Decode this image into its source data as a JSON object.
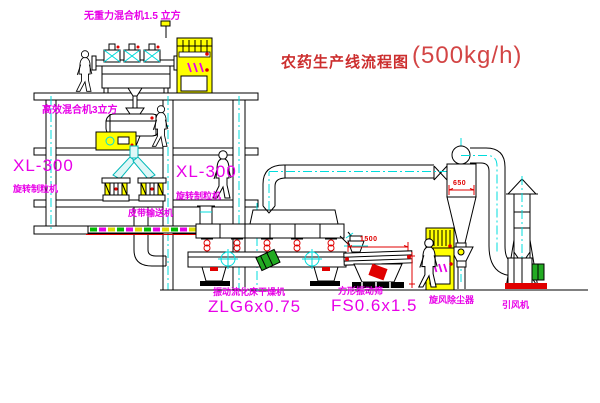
{
  "diagram": {
    "title": "农药生产线流程图",
    "capacity": "(500kg/h)"
  },
  "labels": {
    "top_mixer": "无重力混合机1.5 立方",
    "high_efficiency_mixer": "高效混合机3立方",
    "granulator_left_model": "XL-300",
    "granulator_left_name": "旋转制粒机",
    "granulator_right_model": "XL-300",
    "granulator_right_name": "旋转制粒机",
    "belt_conveyor": "皮带输送机",
    "fluid_bed_dryer_name": "振动流化床干燥机",
    "fluid_bed_dryer_model": "ZLG6x0.75",
    "square_sieve_name": "方形振动筛",
    "square_sieve_model": "FS0.6x1.5",
    "cyclone_dust_collector": "旋风除尘器",
    "induced_draft_fan": "引风机"
  },
  "dimensions": {
    "sieve_length": "1500",
    "cyclone_body": "650"
  },
  "colors": {
    "label_magenta": "#e800e8",
    "title_red": "#cc2e2e",
    "dimension_red": "#e00000",
    "centerline_cyan": "#00dcdc",
    "cabinet_yellow": "#ffff00",
    "motor_green": "#22aa22",
    "line_black": "#000000",
    "background": "#ffffff"
  }
}
